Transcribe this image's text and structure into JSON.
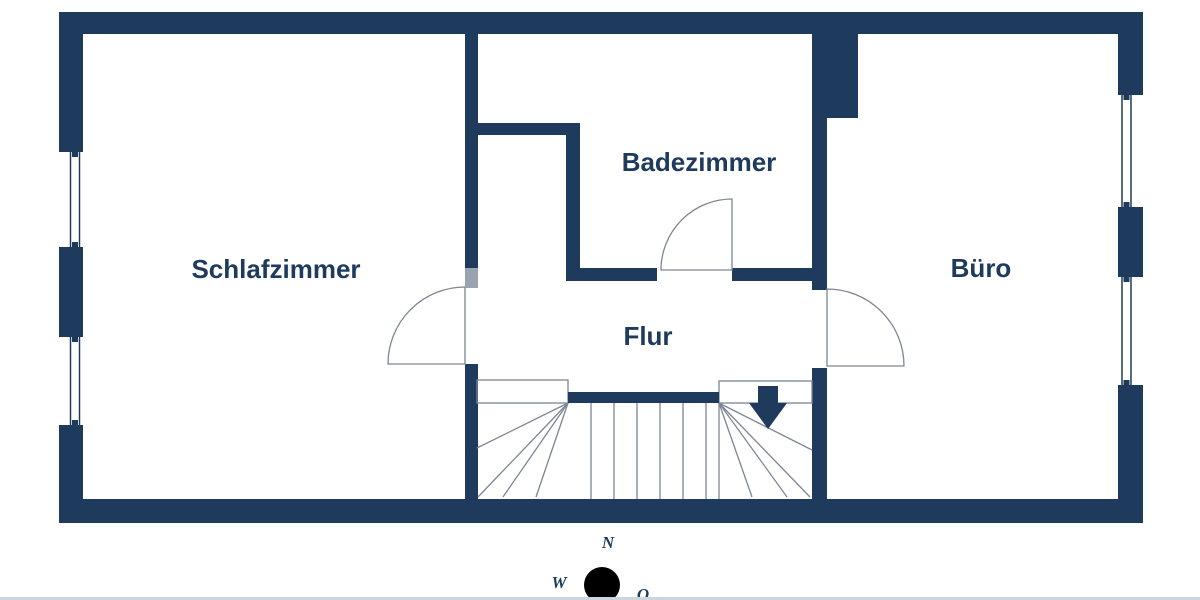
{
  "floorplan": {
    "rooms": [
      {
        "name": "Schlafzimmer"
      },
      {
        "name": "Badezimmer"
      },
      {
        "name": "Flur"
      },
      {
        "name": "Büro"
      }
    ],
    "stairs": {
      "direction": "down"
    },
    "compass": {
      "north": "N",
      "west": "W",
      "east": "O"
    },
    "colors": {
      "wall": "#1e3a5c",
      "door_leaf": "#9aa4b1",
      "thin_line": "#7d8695",
      "background": "#ffffff",
      "edge_strip": "#ccd5dc"
    }
  }
}
